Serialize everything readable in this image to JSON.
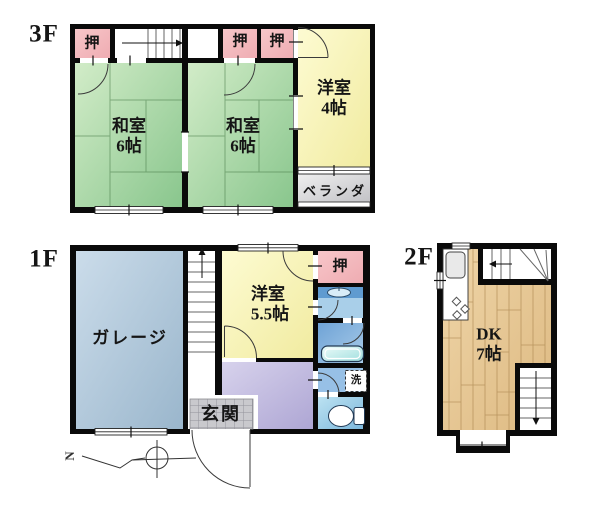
{
  "colors": {
    "wall": "#0a0a0a",
    "closet_pink": "#f4babe",
    "tatami_green": "#9ed29e",
    "western_yellow": "#f7f3b5",
    "veranda_gray": "#d9d9d9",
    "garage_blue": "#aec8da",
    "hall_purple": "#c3bce0",
    "wood_tan": "#e7c794",
    "bath_blue": "#7fa9d8",
    "washroom_blue": "#a9cfe9",
    "toilet_blue": "#a8d6ee",
    "genkan_tile": "#c9c9cd"
  },
  "floors": {
    "f3": {
      "label": "3F",
      "rooms": {
        "washitsu_left": {
          "name": "和室",
          "size": "6帖"
        },
        "washitsu_right": {
          "name": "和室",
          "size": "6帖"
        },
        "yoshitsu": {
          "name": "洋室",
          "size": "4帖"
        },
        "veranda": {
          "name": "ベランダ"
        },
        "closet1": {
          "name": "押"
        },
        "closet2": {
          "name": "押"
        },
        "closet3": {
          "name": "押"
        }
      }
    },
    "f1": {
      "label": "1F",
      "rooms": {
        "garage": {
          "name": "ガレージ"
        },
        "yoshitsu": {
          "name": "洋室",
          "size": "5.5帖"
        },
        "genkan": {
          "name": "玄関"
        },
        "closet": {
          "name": "押"
        },
        "laundry": {
          "name": "洗"
        }
      },
      "compass_north": "N"
    },
    "f2": {
      "label": "2F",
      "rooms": {
        "dk": {
          "name": "DK",
          "size": "7帖"
        }
      }
    }
  }
}
